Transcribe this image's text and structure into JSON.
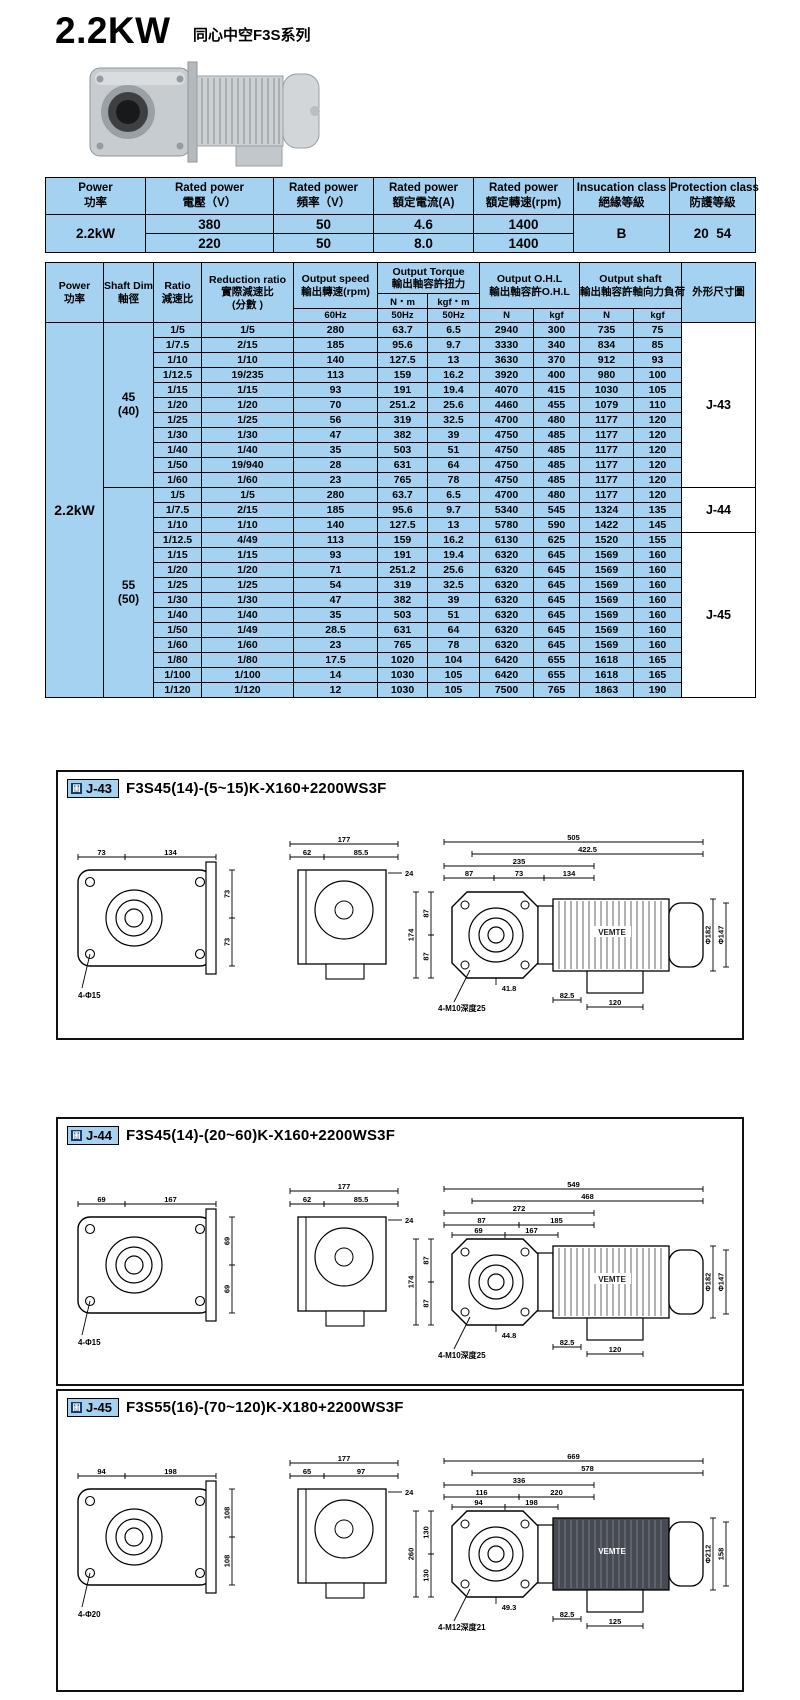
{
  "page": {
    "title": "2.2KW",
    "subtitle": "同心中空F3S系列"
  },
  "spec_table": {
    "headers": [
      {
        "en": "Power",
        "zh": "功率"
      },
      {
        "en": "Rated power",
        "zh": "電壓（V）"
      },
      {
        "en": "Rated power",
        "zh": "頻率（V）"
      },
      {
        "en": "Rated power",
        "zh": "額定電流(A)"
      },
      {
        "en": "Rated power",
        "zh": "額定轉速(rpm)"
      },
      {
        "en": "Insucation class",
        "zh": "絕緣等級"
      },
      {
        "en": "Protection class",
        "zh": "防護等級"
      }
    ],
    "power": "2.2kW",
    "rows": [
      [
        "380",
        "50",
        "4.6",
        "1400"
      ],
      [
        "220",
        "50",
        "8.0",
        "1400"
      ]
    ],
    "insulation": "B",
    "protection": "20  54"
  },
  "ratio_table": {
    "power": "2.2kW",
    "h": {
      "power_en": "Power",
      "power_zh": "功率",
      "shaft_en": "Shaft Dim",
      "shaft_zh": "軸徑",
      "ratio_en": "Ratio",
      "ratio_zh": "減速比",
      "reduction_en": "Reduction ratio",
      "reduction_zh": "實際減速比",
      "reduction_zh2": "(分數 )",
      "speed_en": "Output speed",
      "speed_zh": "輸出轉速(rpm)",
      "torque_en": "Output Torque",
      "torque_zh": "輸出軸容許扭力",
      "ohl_en": "Output O.H.L",
      "ohl_zh": "輸出軸容許O.H.L",
      "shaftload_en": "Output shaft",
      "shaftload_zh": "輸出軸容許軸向力負荷",
      "outline": "外形尺寸圖",
      "nm": "N・m",
      "kgfm": "kgf・m",
      "sub": [
        "60Hz",
        "50Hz",
        "50Hz",
        "N",
        "kgf",
        "N",
        "kgf"
      ]
    },
    "groups": [
      {
        "shaft": "45",
        "shaft_sub": "(40)",
        "rows": [
          [
            "1/5",
            "1/5",
            "280",
            "63.7",
            "6.5",
            "2940",
            "300",
            "735",
            "75"
          ],
          [
            "1/7.5",
            "2/15",
            "185",
            "95.6",
            "9.7",
            "3330",
            "340",
            "834",
            "85"
          ],
          [
            "1/10",
            "1/10",
            "140",
            "127.5",
            "13",
            "3630",
            "370",
            "912",
            "93"
          ],
          [
            "1/12.5",
            "19/235",
            "113",
            "159",
            "16.2",
            "3920",
            "400",
            "980",
            "100"
          ],
          [
            "1/15",
            "1/15",
            "93",
            "191",
            "19.4",
            "4070",
            "415",
            "1030",
            "105"
          ],
          [
            "1/20",
            "1/20",
            "70",
            "251.2",
            "25.6",
            "4460",
            "455",
            "1079",
            "110"
          ],
          [
            "1/25",
            "1/25",
            "56",
            "319",
            "32.5",
            "4700",
            "480",
            "1177",
            "120"
          ],
          [
            "1/30",
            "1/30",
            "47",
            "382",
            "39",
            "4750",
            "485",
            "1177",
            "120"
          ],
          [
            "1/40",
            "1/40",
            "35",
            "503",
            "51",
            "4750",
            "485",
            "1177",
            "120"
          ],
          [
            "1/50",
            "19/940",
            "28",
            "631",
            "64",
            "4750",
            "485",
            "1177",
            "120"
          ],
          [
            "1/60",
            "1/60",
            "23",
            "765",
            "78",
            "4750",
            "485",
            "1177",
            "120"
          ]
        ]
      },
      {
        "shaft": "55",
        "shaft_sub": "(50)",
        "rows": [
          [
            "1/5",
            "1/5",
            "280",
            "63.7",
            "6.5",
            "4700",
            "480",
            "1177",
            "120"
          ],
          [
            "1/7.5",
            "2/15",
            "185",
            "95.6",
            "9.7",
            "5340",
            "545",
            "1324",
            "135"
          ],
          [
            "1/10",
            "1/10",
            "140",
            "127.5",
            "13",
            "5780",
            "590",
            "1422",
            "145"
          ],
          [
            "1/12.5",
            "4/49",
            "113",
            "159",
            "16.2",
            "6130",
            "625",
            "1520",
            "155"
          ],
          [
            "1/15",
            "1/15",
            "93",
            "191",
            "19.4",
            "6320",
            "645",
            "1569",
            "160"
          ],
          [
            "1/20",
            "1/20",
            "71",
            "251.2",
            "25.6",
            "6320",
            "645",
            "1569",
            "160"
          ],
          [
            "1/25",
            "1/25",
            "54",
            "319",
            "32.5",
            "6320",
            "645",
            "1569",
            "160"
          ],
          [
            "1/30",
            "1/30",
            "47",
            "382",
            "39",
            "6320",
            "645",
            "1569",
            "160"
          ],
          [
            "1/40",
            "1/40",
            "35",
            "503",
            "51",
            "6320",
            "645",
            "1569",
            "160"
          ],
          [
            "1/50",
            "1/49",
            "28.5",
            "631",
            "64",
            "6320",
            "645",
            "1569",
            "160"
          ],
          [
            "1/60",
            "1/60",
            "23",
            "765",
            "78",
            "6320",
            "645",
            "1569",
            "160"
          ],
          [
            "1/80",
            "1/80",
            "17.5",
            "1020",
            "104",
            "6420",
            "655",
            "1618",
            "165"
          ],
          [
            "1/100",
            "1/100",
            "14",
            "1030",
            "105",
            "6420",
            "655",
            "1618",
            "165"
          ],
          [
            "1/120",
            "1/120",
            "12",
            "1030",
            "105",
            "7500",
            "765",
            "1863",
            "190"
          ]
        ]
      }
    ],
    "diagram_spans": [
      {
        "label": "J-43",
        "rows": 11
      },
      {
        "label": "J-44",
        "rows": 3
      },
      {
        "label": "J-45",
        "rows": 11
      }
    ]
  },
  "diagrams": [
    {
      "id": "J-43",
      "icon": "圖",
      "title": "F3S45(14)-(5~15)K-X160+2200WS3F",
      "face": {
        "top": [
          "73",
          "134"
        ],
        "side": [
          "73",
          "73"
        ],
        "callout": "4-Φ15"
      },
      "side_view": {
        "width": "177",
        "segs": [
          "62",
          "85.5"
        ],
        "flange": "24"
      },
      "assembly": {
        "overall": [
          "505",
          "422.5",
          "235"
        ],
        "segs": [
          "87",
          "73",
          "134"
        ],
        "segs2": [],
        "left": [
          "174",
          "87",
          "87"
        ],
        "hub": "41.8",
        "right": [
          "Φ182",
          "Φ147"
        ],
        "bottom": [
          "82.5",
          "120"
        ],
        "callout": "4-M10深度25",
        "motor_label": "VEMTE",
        "dark": false
      }
    },
    {
      "id": "J-44",
      "icon": "圖",
      "title": "F3S45(14)-(20~60)K-X160+2200WS3F",
      "face": {
        "top": [
          "69",
          "167"
        ],
        "side": [
          "69",
          "69"
        ],
        "callout": "4-Φ15"
      },
      "side_view": {
        "width": "177",
        "segs": [
          "62",
          "85.5"
        ],
        "flange": "24"
      },
      "assembly": {
        "overall": [
          "549",
          "468",
          "272"
        ],
        "segs": [
          "87",
          "185"
        ],
        "segs2": [
          "69",
          "167"
        ],
        "left": [
          "174",
          "87",
          "87"
        ],
        "hub": "44.8",
        "right": [
          "Φ182",
          "Φ147"
        ],
        "bottom": [
          "82.5",
          "120"
        ],
        "callout": "4-M10深度25",
        "motor_label": "VEMTE",
        "dark": false
      }
    },
    {
      "id": "J-45",
      "icon": "圖",
      "title": "F3S55(16)-(70~120)K-X180+2200WS3F",
      "face": {
        "top": [
          "94",
          "198"
        ],
        "side": [
          "108",
          "108"
        ],
        "callout": "4-Φ20"
      },
      "side_view": {
        "width": "177",
        "segs": [
          "65",
          "97"
        ],
        "flange": "24"
      },
      "assembly": {
        "overall": [
          "669",
          "578",
          "336"
        ],
        "segs": [
          "116",
          "220"
        ],
        "segs2": [
          "94",
          "198"
        ],
        "left": [
          "260",
          "130",
          "130"
        ],
        "hub": "49.3",
        "right": [
          "Φ212",
          "158"
        ],
        "bottom": [
          "82.5",
          "125"
        ],
        "callout": "4-M12深度21",
        "motor_label": "VEMTE",
        "dark": true
      }
    }
  ]
}
